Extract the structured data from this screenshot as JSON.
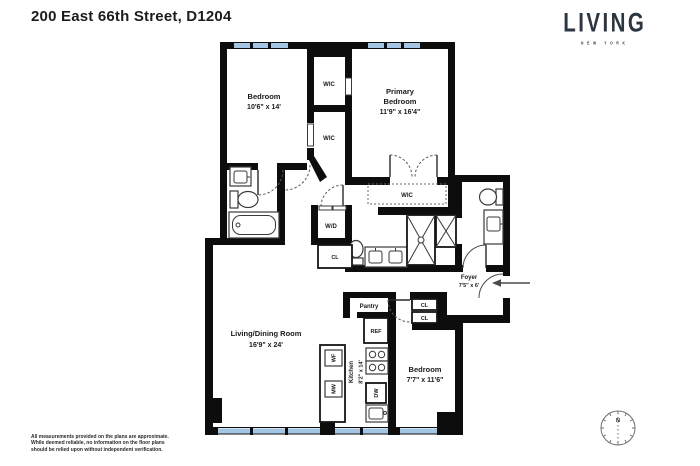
{
  "page": {
    "title": "200 East 66th Street, D1204"
  },
  "logo": {
    "brand": "LIVING",
    "subtitle": "NEW YORK"
  },
  "plan": {
    "bedroom1": {
      "name": "Bedroom",
      "dims": "10'6\" x 14'"
    },
    "primary_bedroom": {
      "line1": "Primary",
      "line2": "Bedroom",
      "dims": "11'9\" x 16'4\""
    },
    "wic_top": {
      "label": "WIC"
    },
    "wic_mid": {
      "label": "WIC"
    },
    "wic_primary": {
      "label": "WIC"
    },
    "washer_dryer": {
      "label": "W/D"
    },
    "closet_hall": {
      "label": "CL"
    },
    "closet_upper": {
      "label": "CL"
    },
    "closet_lower": {
      "label": "CL"
    },
    "foyer": {
      "name": "Foyer",
      "dims": "7'5\" x 6'"
    },
    "pantry": {
      "label": "Pantry"
    },
    "kitchen": {
      "name": "Kitchen",
      "dims": "8'2\" x 14'"
    },
    "living_dining": {
      "name": "Living/Dining Room",
      "dims": "16'9\" x 24'"
    },
    "bedroom3": {
      "name": "Bedroom",
      "dims": "7'7\" x 11'6\""
    },
    "appliances": {
      "ref": "REF",
      "dw": "DW",
      "wf": "WF",
      "mw": "MW"
    }
  },
  "compass": {
    "north": "N"
  },
  "disclaimer": {
    "line1": "All measurements provided on the plans are approximate.",
    "line2": "While deemed reliable, no information on the floor plans",
    "line3": "should be relied upon without independent verification."
  },
  "colors": {
    "wall": "#0d0d0d",
    "window": "#a5c6e2",
    "brand": "#2b3640"
  }
}
